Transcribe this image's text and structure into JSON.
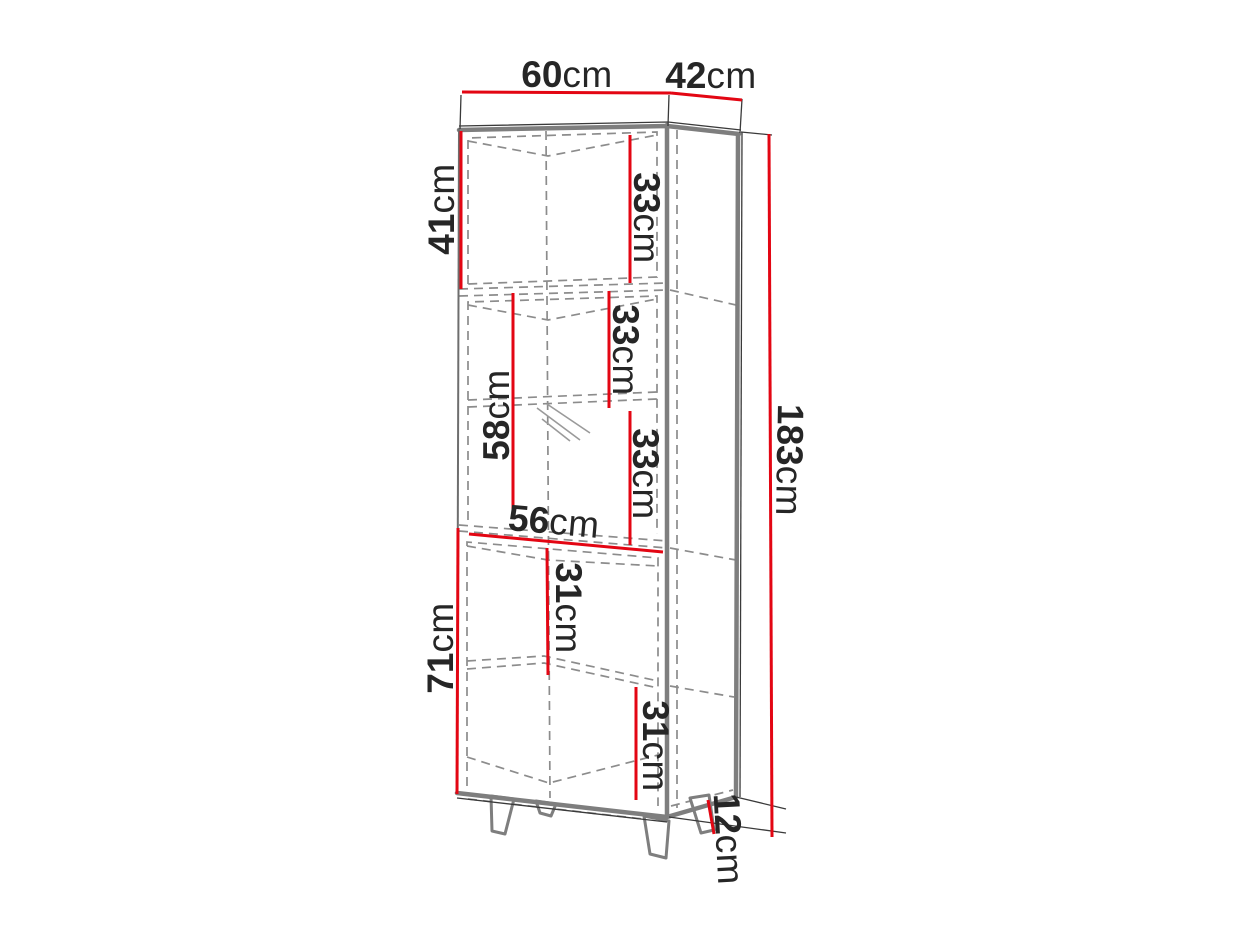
{
  "diagram": {
    "unit": "cm",
    "colors": {
      "dimension_line": "#e30613",
      "cabinet_edge": "#7e7e7e",
      "hidden_line": "#8c8c8c",
      "label_text": "#262626",
      "background": "#ffffff"
    },
    "dims": {
      "w60": {
        "value": "60",
        "unit": "cm"
      },
      "d42": {
        "value": "42",
        "unit": "cm"
      },
      "h41": {
        "value": "41",
        "unit": "cm"
      },
      "s33a": {
        "value": "33",
        "unit": "cm"
      },
      "s33b": {
        "value": "33",
        "unit": "cm"
      },
      "g58": {
        "value": "58",
        "unit": "cm"
      },
      "s33c": {
        "value": "33",
        "unit": "cm"
      },
      "w56": {
        "value": "56",
        "unit": "cm"
      },
      "s31a": {
        "value": "31",
        "unit": "cm"
      },
      "h71": {
        "value": "71",
        "unit": "cm"
      },
      "s31b": {
        "value": "31",
        "unit": "cm"
      },
      "h183": {
        "value": "183",
        "unit": "cm"
      },
      "l12": {
        "value": "12",
        "unit": "cm"
      }
    }
  }
}
